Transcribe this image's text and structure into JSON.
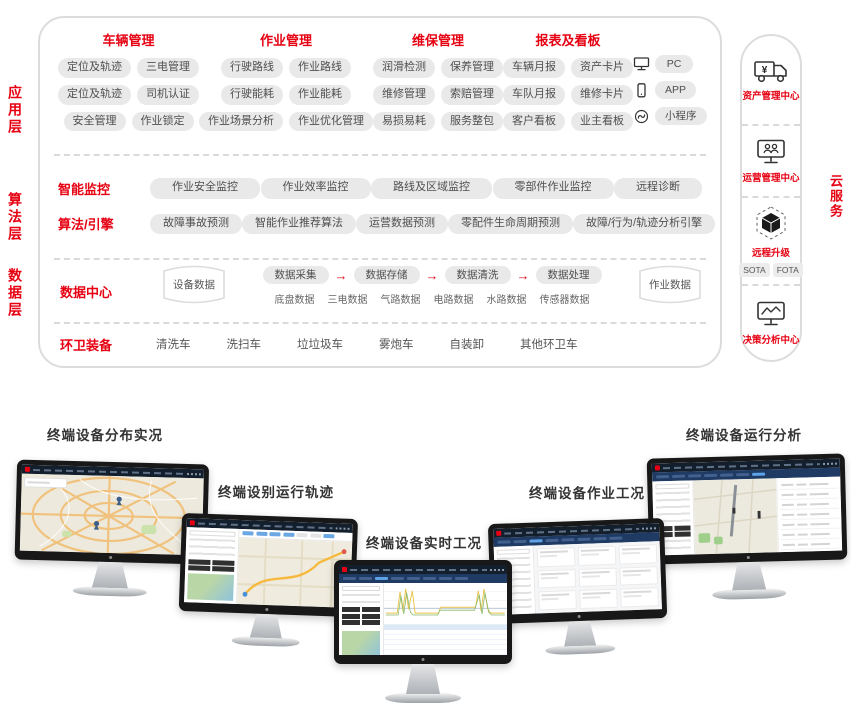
{
  "palette": {
    "accent_red": "#e60012",
    "pill_bg": "#e9e9e9",
    "pill_text": "#4f4f4f",
    "panel_border": "#dcdcdc",
    "navbar_navy": "#141f2e",
    "tab_blue": "#5ea2e8"
  },
  "layers": [
    {
      "label": "应用层"
    },
    {
      "label": "算法层"
    },
    {
      "label": "数据层"
    }
  ],
  "app_layer": {
    "groups": [
      {
        "title": "车辆管理",
        "rows": [
          [
            "定位及轨迹",
            "三电管理"
          ],
          [
            "定位及轨迹",
            "司机认证"
          ],
          [
            "安全管理",
            "作业锁定"
          ]
        ]
      },
      {
        "title": "作业管理",
        "rows": [
          [
            "行驶路线",
            "作业路线"
          ],
          [
            "行驶能耗",
            "作业能耗"
          ],
          [
            "作业场景分析",
            "作业优化管理"
          ]
        ]
      },
      {
        "title": "维保管理",
        "rows": [
          [
            "润滑检测",
            "保养管理"
          ],
          [
            "维修管理",
            "索赔管理"
          ],
          [
            "易损易耗",
            "服务整包"
          ]
        ]
      },
      {
        "title": "报表及看板",
        "rows": [
          [
            "车辆月报",
            "资产卡片"
          ],
          [
            "车队月报",
            "维修卡片"
          ],
          [
            "客户看板",
            "业主看板"
          ]
        ]
      }
    ],
    "devices": [
      {
        "icon": "pc-icon",
        "label": "PC"
      },
      {
        "icon": "phone-icon",
        "label": "APP"
      },
      {
        "icon": "link-icon",
        "label": "小程序"
      }
    ]
  },
  "algo_layer": {
    "rows": [
      {
        "title": "智能监控",
        "pills": [
          "作业安全监控",
          "作业效率监控",
          "路线及区域监控",
          "零部件作业监控",
          "远程诊断"
        ]
      },
      {
        "title": "算法/引擎",
        "pills": [
          "故障事故预测",
          "智能作业推荐算法",
          "运营数据预测",
          "零配件生命周期预测",
          "故障/行为/轨迹分析引擎"
        ]
      }
    ]
  },
  "data_layer": {
    "title": "数据中心",
    "left_db": "设备数据",
    "pipeline": [
      "数据采集",
      "数据存储",
      "数据清洗",
      "数据处理"
    ],
    "arrow": "→",
    "sources": [
      "底盘数据",
      "三电数据",
      "气路数据",
      "电路数据",
      "水路数据",
      "传感器数据"
    ],
    "right_db": "作业数据"
  },
  "equipment": {
    "title": "环卫装备",
    "items": [
      "清洗车",
      "洗扫车",
      "垃垃圾车",
      "雾炮车",
      "自装卸",
      "其他环卫车"
    ]
  },
  "cloud": {
    "vertical_label": "云服务",
    "items": [
      {
        "icon": "truck-yen-icon",
        "label": "资产管理中心"
      },
      {
        "icon": "monitor-users-icon",
        "label": "运营管理中心"
      },
      {
        "icon": "ota-cube-icon",
        "label": "远程升级",
        "pills": [
          "SOTA",
          "FOTA"
        ]
      },
      {
        "icon": "monitor-chart-icon",
        "label": "决策分析中心"
      }
    ]
  },
  "monitors": [
    {
      "label": "终端设备分布实况",
      "screen": "map-overview"
    },
    {
      "label": "终端设别运行轨迹",
      "screen": "track-map"
    },
    {
      "label": "终端设备实时工况",
      "screen": "realtime-chart"
    },
    {
      "label": "终端设备作业工况",
      "screen": "work-status-list"
    },
    {
      "label": "终端设备运行分析",
      "screen": "analysis-map-table"
    }
  ]
}
